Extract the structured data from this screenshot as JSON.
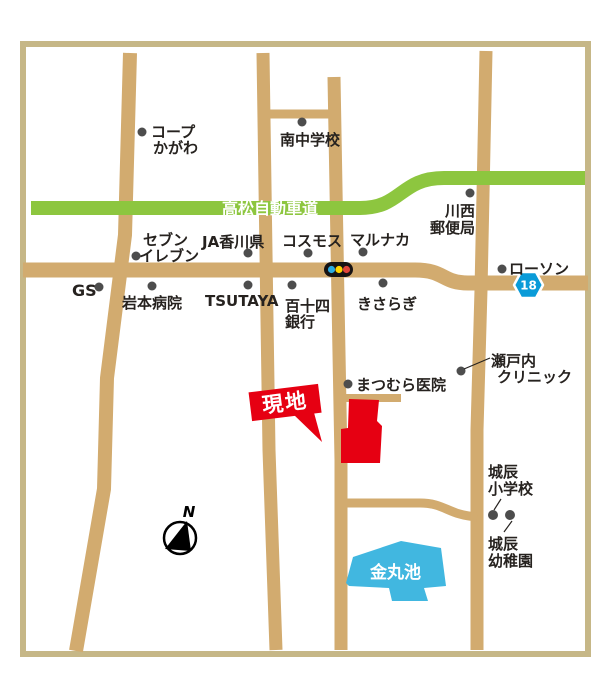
{
  "map": {
    "expressway": {
      "label": "高松自動車道"
    },
    "site_marker": {
      "label": "現地"
    },
    "route_badge": {
      "number": "18"
    },
    "compass": {
      "label": "N"
    },
    "pond": {
      "label": "金丸池"
    },
    "landmarks": {
      "coop_kagawa": {
        "line1": "コープ",
        "line2": "かがわ"
      },
      "minami_junior_high": {
        "line1": "南中学校"
      },
      "kawanishi_post_office": {
        "line1": "川西",
        "line2": "郵便局"
      },
      "seven_eleven": {
        "line1": "セブン",
        "line2": "イレブン"
      },
      "ja_kagawa": {
        "line1": "JA香川県"
      },
      "cosmos": {
        "line1": "コスモス"
      },
      "marunaka": {
        "line1": "マルナカ"
      },
      "gs": {
        "line1": "GS"
      },
      "iwamoto_hospital": {
        "line1": "岩本病院"
      },
      "tsutaya": {
        "line1": "TSUTAYA"
      },
      "hyakujushi_bank": {
        "line1": "百十四",
        "line2": "銀行"
      },
      "kisaragi": {
        "line1": "きさらぎ"
      },
      "lawson": {
        "line1": "ローソン"
      },
      "matsumura_clinic": {
        "line1": "まつむら医院"
      },
      "setouchi_clinic": {
        "line1": "瀬戸内",
        "line2": "クリニック"
      },
      "shirotatsu_elementary": {
        "line1": "城辰",
        "line2": "小学校"
      },
      "shirotatsu_kindergarten": {
        "line1": "城辰",
        "line2": "幼稚園"
      }
    },
    "colors": {
      "road_tan": "#d2ab6f",
      "frame_tan": "#c6b787",
      "expressway_green": "#8dc63f",
      "site_red": "#e60012",
      "pond_blue": "#41b7e0",
      "route_badge_blue": "#0a9bd8",
      "signal_blue": "#29abe2",
      "signal_yellow": "#ffd400",
      "signal_red": "#e0443a",
      "landmark_dot_gray": "#4d4d4d"
    }
  }
}
